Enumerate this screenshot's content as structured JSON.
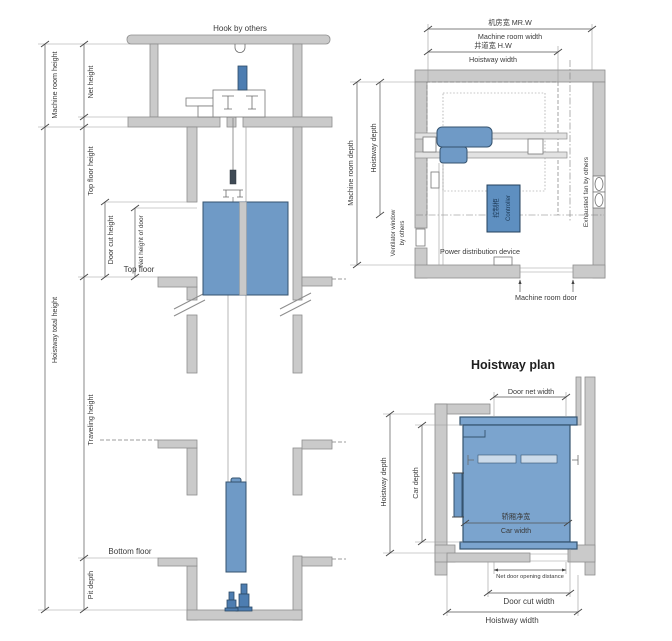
{
  "diagram": {
    "elevation": {
      "hook_label": "Hook by others",
      "dims": {
        "machine_room_height": "Machine room height",
        "net_height": "Net height",
        "top_floor_height": "Top floor height",
        "door_cut_height": "Door cut height",
        "net_height_of_door": "Net height of door",
        "hoistway_total_height": "Hoistway total height",
        "traveling_height": "Traveling height",
        "pit_depth": "Pit depth"
      },
      "floors": {
        "top_floor": "Top floor",
        "bottom_floor": "Bottom floor"
      }
    },
    "machine_room_plan": {
      "dims": {
        "machine_room_width_cn": "机房宽 MR.W",
        "machine_room_width": "Machine room width",
        "hoistway_width_cn": "井道宽 H.W",
        "hoistway_width": "Hoistway width",
        "machine_room_depth": "Machine room depth",
        "hoistway_depth": "Hoistway depth"
      },
      "labels": {
        "ventilator_line1": "Ventilator window",
        "ventilator_line2": "by others",
        "exhausted_fan": "Exhausted fan by others",
        "controller_cn": "控制柜",
        "controller_en": "Controller",
        "power_distribution": "Power distribution device",
        "machine_room_door": "Machine room door"
      }
    },
    "hoistway_plan": {
      "title": "Hoistway plan",
      "dims": {
        "door_net_width": "Door net width",
        "hoistway_depth": "Hoistway depth",
        "car_depth": "Car depth",
        "car_width_cn": "轿厢净宽",
        "car_width": "Car width",
        "net_door_opening": "Net door opening distance",
        "door_cut_width": "Door cut width",
        "hoistway_width": "Hoistway width"
      }
    },
    "colors": {
      "wall_gray": "#cacaca",
      "component_blue": "#6f9ac6",
      "component_blue_dark": "#4d7db1",
      "line_gray": "#6b6b6b"
    }
  }
}
